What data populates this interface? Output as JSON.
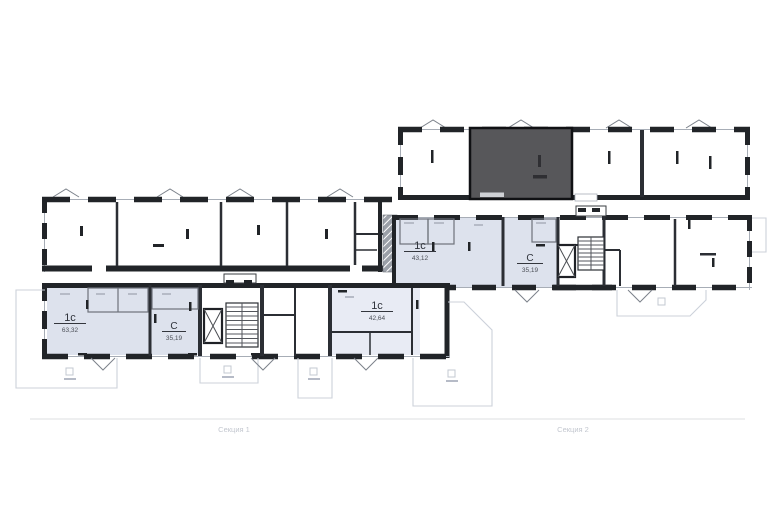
{
  "plan": {
    "section_axis": {
      "section1": "Секция 1",
      "section2": "Секция 2"
    },
    "apartments": [
      {
        "type": "1с",
        "area": "63,32"
      },
      {
        "type": "С",
        "area": "35,19"
      },
      {
        "type": "1с",
        "area": "42,64"
      },
      {
        "type": "1с",
        "area": "43,12"
      },
      {
        "type": "С",
        "area": "35,19"
      }
    ],
    "colors": {
      "wall": "#212428",
      "apartment_fill": "#dde2ed",
      "apartment_fill_light": "#e8ebf4",
      "highlight_fill": "#57575a",
      "faint_outline": "#ccd1da"
    }
  }
}
